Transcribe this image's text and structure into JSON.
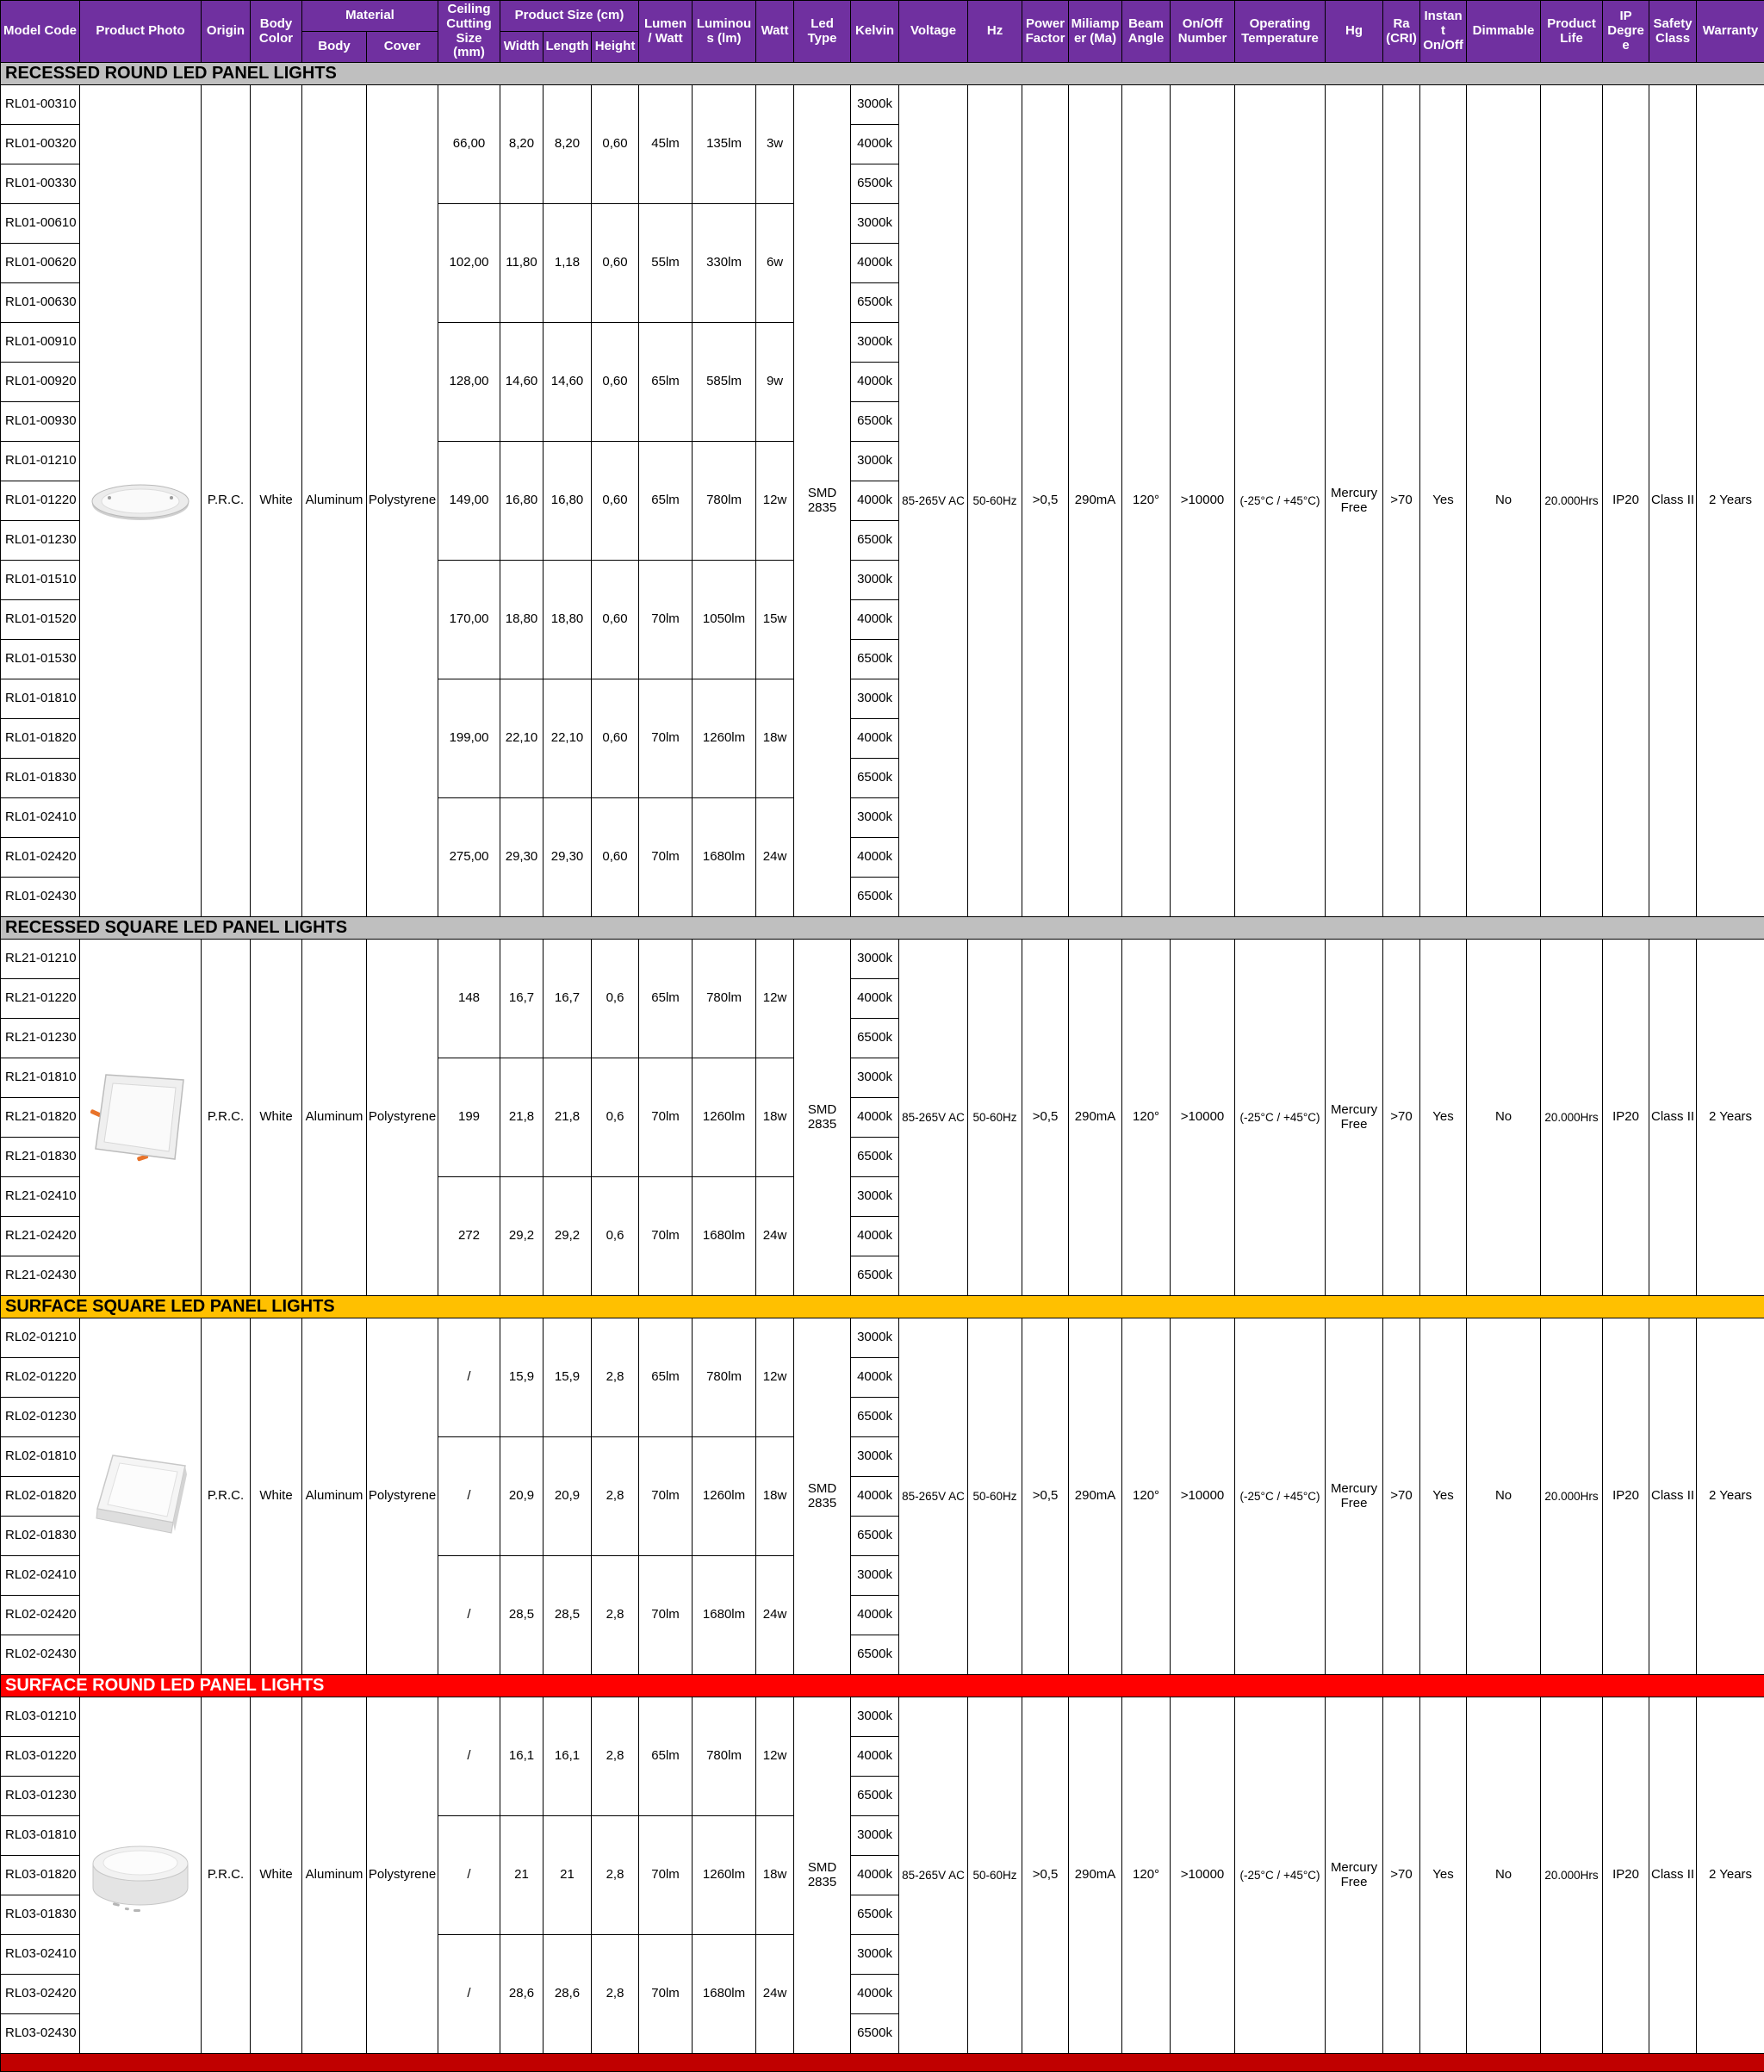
{
  "colors": {
    "header_bg": "#7030A0",
    "header_text": "#FFFFFF",
    "grid": "#000000",
    "section_recessed_bg": "#BFBFBF",
    "section_surface_square_bg": "#FFC000",
    "section_surface_round_bg": "#FF0000",
    "section_text_dark": "#000000",
    "section_text_light": "#FFFFFF",
    "footer_bg": "#C00000"
  },
  "header": {
    "model_code": "Model Code",
    "product_photo": "Product Photo",
    "origin": "Origin",
    "body_color": "Body Color",
    "material": "Material",
    "body": "Body",
    "cover": "Cover",
    "ceiling_cutting": "Ceiling Cutting Size (mm)",
    "product_size": "Product Size (cm)",
    "width": "Width",
    "length": "Length",
    "height": "Height",
    "lumen_watt": "Lumen / Watt",
    "luminous": "Luminous (lm)",
    "watt": "Watt",
    "led_type": "Led Type",
    "kelvin": "Kelvin",
    "voltage": "Voltage",
    "hz": "Hz",
    "power_factor": "Power Factor",
    "miliamper": "Miliamper (Ma)",
    "beam_angle": "Beam Angle",
    "on_off_number": "On/Off Number",
    "operating_temperature": "Operating Temperature",
    "hg": "Hg",
    "ra_cri": "Ra (CRI)",
    "instant_on_off": "Instant On/Off",
    "dimmable": "Dimmable",
    "product_life": "Product Life",
    "ip_degree": "IP Degree",
    "safety_class": "Safety Class",
    "warranty": "Warranty"
  },
  "kelvin_options": [
    "3000k",
    "4000k",
    "6500k"
  ],
  "common": {
    "origin": "P.R.C.",
    "body_color": "White",
    "material_body": "Aluminum",
    "material_cover": "Polystyrene",
    "led_type": "SMD 2835",
    "voltage": "85-265V AC",
    "hz": "50-60Hz",
    "power_factor": ">0,5",
    "miliamper": "290mA",
    "beam_angle": "120°",
    "on_off_number": ">10000",
    "operating_temperature": "(-25°C / +45°C)",
    "hg": "Mercury Free",
    "ra_cri": ">70",
    "instant_on_off": "Yes",
    "dimmable": "No",
    "product_life": "20.000Hrs",
    "ip_degree": "IP20",
    "safety_class": "Class II",
    "warranty": "2 Years"
  },
  "sections": [
    {
      "title": "RECESSED ROUND LED PANEL LIGHTS",
      "bg": "#BFBFBF",
      "fg": "#000000",
      "photo": "recessed-round",
      "groups": [
        {
          "models": [
            "RL01-00310",
            "RL01-00320",
            "RL01-00330"
          ],
          "cutting": "66,00",
          "width": "8,20",
          "length": "8,20",
          "height": "0,60",
          "lumen_watt": "45lm",
          "luminous": "135lm",
          "watt": "3w"
        },
        {
          "models": [
            "RL01-00610",
            "RL01-00620",
            "RL01-00630"
          ],
          "cutting": "102,00",
          "width": "11,80",
          "length": "1,18",
          "height": "0,60",
          "lumen_watt": "55lm",
          "luminous": "330lm",
          "watt": "6w"
        },
        {
          "models": [
            "RL01-00910",
            "RL01-00920",
            "RL01-00930"
          ],
          "cutting": "128,00",
          "width": "14,60",
          "length": "14,60",
          "height": "0,60",
          "lumen_watt": "65lm",
          "luminous": "585lm",
          "watt": "9w"
        },
        {
          "models": [
            "RL01-01210",
            "RL01-01220",
            "RL01-01230"
          ],
          "cutting": "149,00",
          "width": "16,80",
          "length": "16,80",
          "height": "0,60",
          "lumen_watt": "65lm",
          "luminous": "780lm",
          "watt": "12w"
        },
        {
          "models": [
            "RL01-01510",
            "RL01-01520",
            "RL01-01530"
          ],
          "cutting": "170,00",
          "width": "18,80",
          "length": "18,80",
          "height": "0,60",
          "lumen_watt": "70lm",
          "luminous": "1050lm",
          "watt": "15w"
        },
        {
          "models": [
            "RL01-01810",
            "RL01-01820",
            "RL01-01830"
          ],
          "cutting": "199,00",
          "width": "22,10",
          "length": "22,10",
          "height": "0,60",
          "lumen_watt": "70lm",
          "luminous": "1260lm",
          "watt": "18w"
        },
        {
          "models": [
            "RL01-02410",
            "RL01-02420",
            "RL01-02430"
          ],
          "cutting": "275,00",
          "width": "29,30",
          "length": "29,30",
          "height": "0,60",
          "lumen_watt": "70lm",
          "luminous": "1680lm",
          "watt": "24w"
        }
      ]
    },
    {
      "title": "RECESSED SQUARE LED PANEL LIGHTS",
      "bg": "#BFBFBF",
      "fg": "#000000",
      "photo": "recessed-square",
      "groups": [
        {
          "models": [
            "RL21-01210",
            "RL21-01220",
            "RL21-01230"
          ],
          "cutting": "148",
          "width": "16,7",
          "length": "16,7",
          "height": "0,6",
          "lumen_watt": "65lm",
          "luminous": "780lm",
          "watt": "12w"
        },
        {
          "models": [
            "RL21-01810",
            "RL21-01820",
            "RL21-01830"
          ],
          "cutting": "199",
          "width": "21,8",
          "length": "21,8",
          "height": "0,6",
          "lumen_watt": "70lm",
          "luminous": "1260lm",
          "watt": "18w"
        },
        {
          "models": [
            "RL21-02410",
            "RL21-02420",
            "RL21-02430"
          ],
          "cutting": "272",
          "width": "29,2",
          "length": "29,2",
          "height": "0,6",
          "lumen_watt": "70lm",
          "luminous": "1680lm",
          "watt": "24w"
        }
      ]
    },
    {
      "title": "SURFACE SQUARE LED PANEL LIGHTS",
      "bg": "#FFC000",
      "fg": "#000000",
      "photo": "surface-square",
      "groups": [
        {
          "models": [
            "RL02-01210",
            "RL02-01220",
            "RL02-01230"
          ],
          "cutting": "/",
          "width": "15,9",
          "length": "15,9",
          "height": "2,8",
          "lumen_watt": "65lm",
          "luminous": "780lm",
          "watt": "12w"
        },
        {
          "models": [
            "RL02-01810",
            "RL02-01820",
            "RL02-01830"
          ],
          "cutting": "/",
          "width": "20,9",
          "length": "20,9",
          "height": "2,8",
          "lumen_watt": "70lm",
          "luminous": "1260lm",
          "watt": "18w"
        },
        {
          "models": [
            "RL02-02410",
            "RL02-02420",
            "RL02-02430"
          ],
          "cutting": "/",
          "width": "28,5",
          "length": "28,5",
          "height": "2,8",
          "lumen_watt": "70lm",
          "luminous": "1680lm",
          "watt": "24w"
        }
      ]
    },
    {
      "title": "SURFACE ROUND LED PANEL LIGHTS",
      "bg": "#FF0000",
      "fg": "#FFFFFF",
      "photo": "surface-round",
      "groups": [
        {
          "models": [
            "RL03-01210",
            "RL03-01220",
            "RL03-01230"
          ],
          "cutting": "/",
          "width": "16,1",
          "length": "16,1",
          "height": "2,8",
          "lumen_watt": "65lm",
          "luminous": "780lm",
          "watt": "12w"
        },
        {
          "models": [
            "RL03-01810",
            "RL03-01820",
            "RL03-01830"
          ],
          "cutting": "/",
          "width": "21",
          "length": "21",
          "height": "2,8",
          "lumen_watt": "70lm",
          "luminous": "1260lm",
          "watt": "18w"
        },
        {
          "models": [
            "RL03-02410",
            "RL03-02420",
            "RL03-02430"
          ],
          "cutting": "/",
          "width": "28,6",
          "length": "28,6",
          "height": "2,8",
          "lumen_watt": "70lm",
          "luminous": "1680lm",
          "watt": "24w"
        }
      ]
    }
  ]
}
